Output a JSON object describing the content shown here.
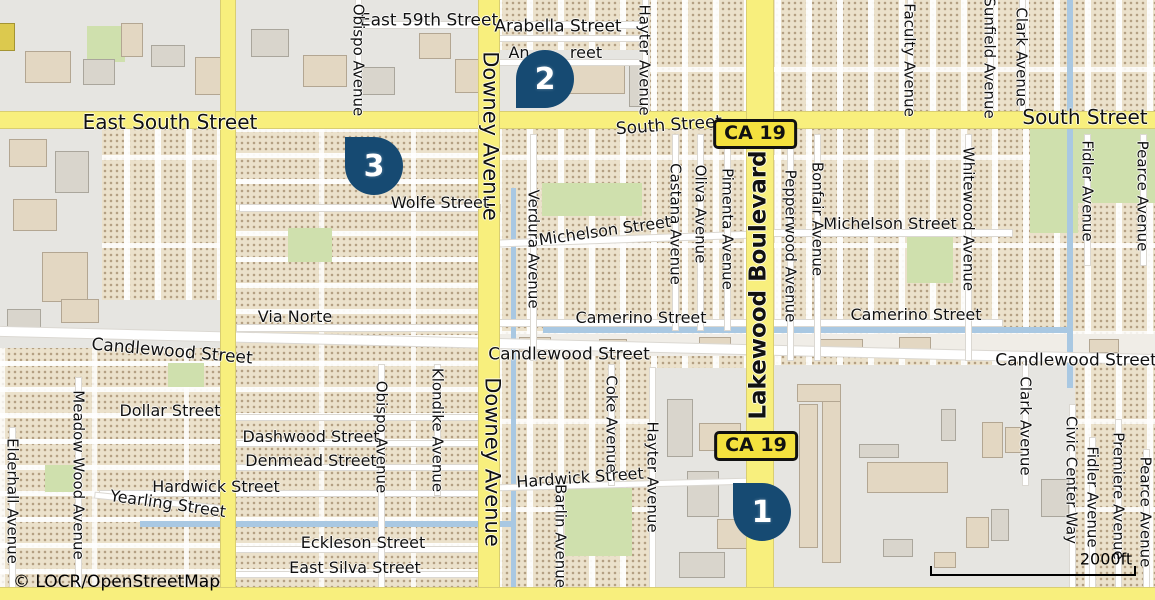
{
  "map": {
    "attribution": "© LOCR/OpenStreetMap",
    "scale_label": "2000ft",
    "route_shield": "CA 19",
    "colors": {
      "road-major": "#f8ef7d",
      "road-casing": "#d9ce72",
      "water": "#a9c8e2",
      "park": "#cfe0ad",
      "marker": "#164a72",
      "shield-bg": "#f4e13e",
      "label": "#111111",
      "residential": "#ebe1cb",
      "industrial": "#e6e5e1",
      "building": "#e3d7c2"
    }
  },
  "badges": [
    {
      "x": 755,
      "y": 134
    },
    {
      "x": 756,
      "y": 446
    }
  ],
  "markers": [
    {
      "n": "1",
      "x": 733,
      "y": 483,
      "tip": "tl"
    },
    {
      "n": "2",
      "x": 516,
      "y": 50,
      "tip": "bl"
    },
    {
      "n": "3",
      "x": 345,
      "y": 137,
      "tip": "tl"
    }
  ],
  "labels": [
    {
      "t": "East 59th Street",
      "x": 429,
      "y": 21,
      "s": 17
    },
    {
      "t": "Arabella Street",
      "x": 558,
      "y": 27,
      "s": 17
    },
    {
      "t": "An",
      "x": 519,
      "y": 53,
      "s": 16
    },
    {
      "t": "reet",
      "x": 586,
      "y": 53,
      "s": 16
    },
    {
      "t": "East South Street",
      "x": 170,
      "y": 122,
      "s": 20
    },
    {
      "t": "South Street",
      "x": 669,
      "y": 126,
      "r": -4,
      "s": 17
    },
    {
      "t": "South Street",
      "x": 1085,
      "y": 117,
      "s": 20
    },
    {
      "t": "Obispo Avenue",
      "x": 358,
      "y": 60,
      "r": 90,
      "s": 15
    },
    {
      "t": "Downey Avenue",
      "x": 490,
      "y": 136,
      "r": 90,
      "s": 21
    },
    {
      "t": "Hayter Avenue",
      "x": 644,
      "y": 60,
      "r": 90,
      "s": 15
    },
    {
      "t": "Faculty Avenue",
      "x": 909,
      "y": 60,
      "r": 90,
      "s": 15
    },
    {
      "t": "Sunfield Avenue",
      "x": 989,
      "y": 58,
      "r": 90,
      "s": 15
    },
    {
      "t": "Clark Avenue",
      "x": 1021,
      "y": 57,
      "r": 90,
      "s": 15
    },
    {
      "t": "Lakewood Boulevard",
      "x": 759,
      "y": 285,
      "r": -90,
      "s": 23,
      "w": 700
    },
    {
      "t": "Pepperwood Avenue",
      "x": 790,
      "y": 246,
      "r": 90,
      "s": 15
    },
    {
      "t": "Bonfair Avenue",
      "x": 817,
      "y": 219,
      "r": 90,
      "s": 15
    },
    {
      "t": "Castana Avenue",
      "x": 675,
      "y": 224,
      "r": 90,
      "s": 15
    },
    {
      "t": "Oliva Avenue",
      "x": 700,
      "y": 214,
      "r": 90,
      "s": 15
    },
    {
      "t": "Pimenta Avenue",
      "x": 727,
      "y": 229,
      "r": 90,
      "s": 15
    },
    {
      "t": "Verdura Avenue",
      "x": 533,
      "y": 249,
      "r": 90,
      "s": 15
    },
    {
      "t": "Whitewood Avenue",
      "x": 968,
      "y": 219,
      "r": 90,
      "s": 15
    },
    {
      "t": "Fidler Avenue",
      "x": 1087,
      "y": 191,
      "r": 90,
      "s": 15
    },
    {
      "t": "Pearce Avenue",
      "x": 1142,
      "y": 196,
      "r": 90,
      "s": 15
    },
    {
      "t": "Wolfe Street",
      "x": 440,
      "y": 203,
      "s": 16
    },
    {
      "t": "Michelson Street",
      "x": 605,
      "y": 231,
      "r": -8,
      "s": 16
    },
    {
      "t": "Michelson Street",
      "x": 890,
      "y": 224,
      "s": 16
    },
    {
      "t": "Via Norte",
      "x": 295,
      "y": 317,
      "s": 16
    },
    {
      "t": "Camerino Street",
      "x": 641,
      "y": 318,
      "s": 16
    },
    {
      "t": "Camerino Street",
      "x": 916,
      "y": 315,
      "s": 16
    },
    {
      "t": "Candlewood Street",
      "x": 172,
      "y": 352,
      "r": 5,
      "s": 17
    },
    {
      "t": "Candlewood Street",
      "x": 569,
      "y": 355,
      "s": 17
    },
    {
      "t": "Candlewood Street",
      "x": 1076,
      "y": 361,
      "s": 17
    },
    {
      "t": "Dollar Street",
      "x": 170,
      "y": 411,
      "s": 16
    },
    {
      "t": "Dashwood Street",
      "x": 311,
      "y": 437,
      "s": 16
    },
    {
      "t": "Denmead Street",
      "x": 311,
      "y": 461,
      "s": 16
    },
    {
      "t": "Hardwick Street",
      "x": 216,
      "y": 487,
      "s": 16
    },
    {
      "t": "Hardwick Street",
      "x": 580,
      "y": 478,
      "r": -4,
      "s": 16
    },
    {
      "t": "Yearling Street",
      "x": 168,
      "y": 504,
      "r": 8,
      "s": 16
    },
    {
      "t": "Eckleson Street",
      "x": 363,
      "y": 543,
      "s": 16
    },
    {
      "t": "East Silva Street",
      "x": 355,
      "y": 568,
      "s": 16
    },
    {
      "t": "Obispo Avenue",
      "x": 381,
      "y": 437,
      "r": 90,
      "s": 15
    },
    {
      "t": "Klondike Avenue",
      "x": 437,
      "y": 430,
      "r": 90,
      "s": 15
    },
    {
      "t": "Downey Avenue",
      "x": 492,
      "y": 462,
      "r": 90,
      "s": 21
    },
    {
      "t": "Coke Avenue",
      "x": 611,
      "y": 424,
      "r": 90,
      "s": 15
    },
    {
      "t": "Hayter Avenue",
      "x": 652,
      "y": 477,
      "r": 90,
      "s": 15
    },
    {
      "t": "Barlin Avenue",
      "x": 560,
      "y": 536,
      "r": 90,
      "s": 15
    },
    {
      "t": "Meadow Wood Avenue",
      "x": 78,
      "y": 475,
      "r": 90,
      "s": 15
    },
    {
      "t": "Elderhall Avenue",
      "x": 12,
      "y": 501,
      "r": 90,
      "s": 15
    },
    {
      "t": "Clark Avenue",
      "x": 1025,
      "y": 426,
      "r": 90,
      "s": 15
    },
    {
      "t": "Civic Center Way",
      "x": 1071,
      "y": 480,
      "r": 90,
      "s": 15
    },
    {
      "t": "Fidler Avenue",
      "x": 1092,
      "y": 497,
      "r": 90,
      "s": 15
    },
    {
      "t": "Premiere Avenue",
      "x": 1118,
      "y": 496,
      "r": 90,
      "s": 15
    },
    {
      "t": "Pearce Avenue",
      "x": 1145,
      "y": 512,
      "r": 90,
      "s": 15
    }
  ]
}
